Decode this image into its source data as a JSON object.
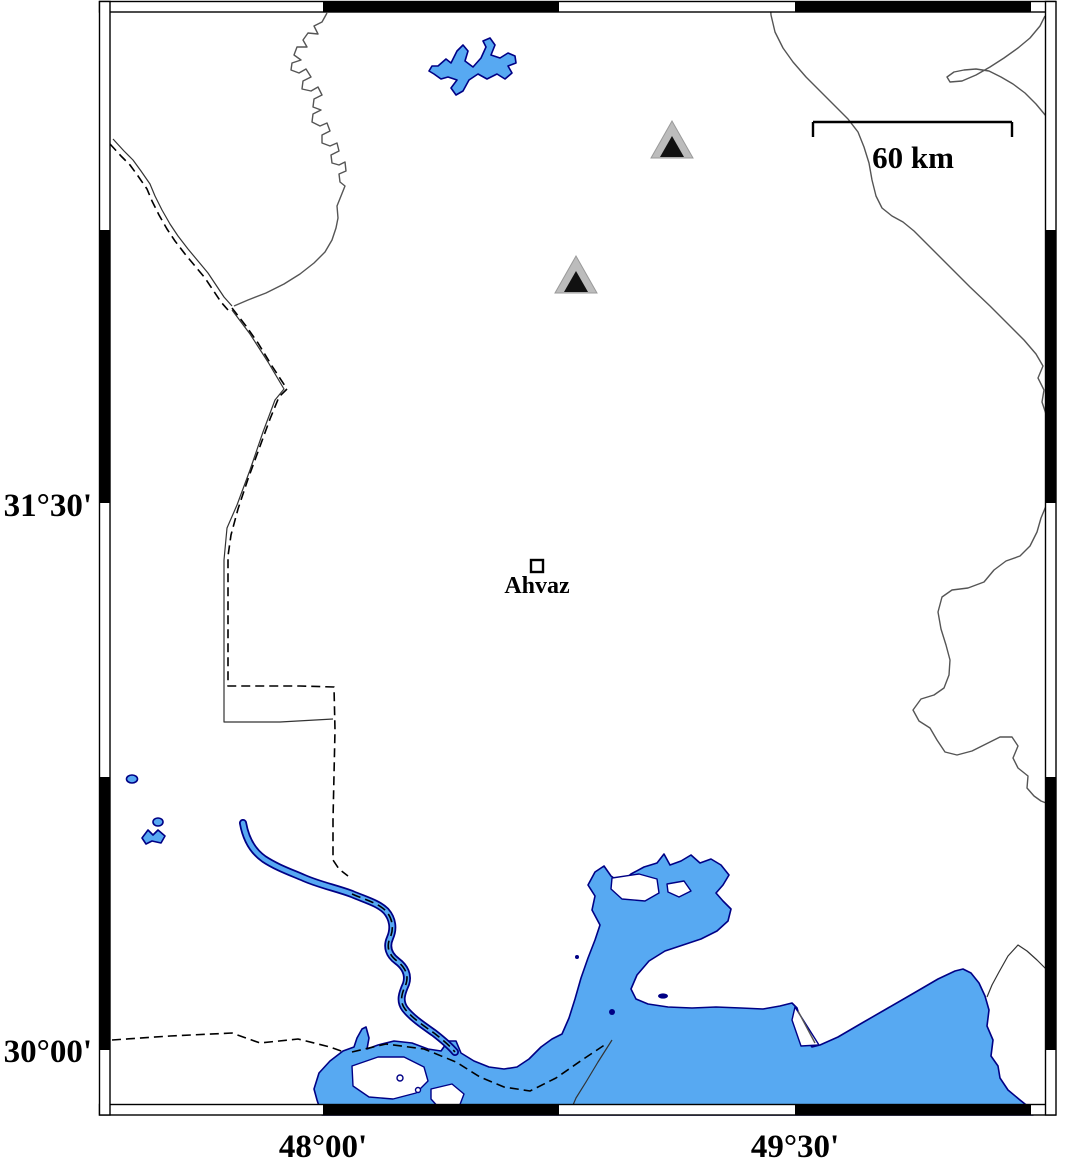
{
  "map": {
    "city_marker": {
      "label": "Ahvaz",
      "symbol": "open-square"
    },
    "scale_bar": {
      "label": "60 km"
    },
    "axes": {
      "left": [
        {
          "label": "31°30'"
        },
        {
          "label": "30°00'"
        }
      ],
      "bottom": [
        {
          "label": "48°00'"
        },
        {
          "label": "49°30'"
        }
      ]
    },
    "stations": [
      {
        "symbol": "filled-triangle"
      },
      {
        "symbol": "filled-triangle"
      }
    ],
    "colors": {
      "water_fill": "#57a9f2",
      "water_outline": "#000085",
      "land": "#ffffff",
      "frame": "#000000",
      "boundary_line": "#555555",
      "border_dash": "#000000",
      "station_outer": "#bcbcbc",
      "station_inner": "#111111"
    }
  }
}
